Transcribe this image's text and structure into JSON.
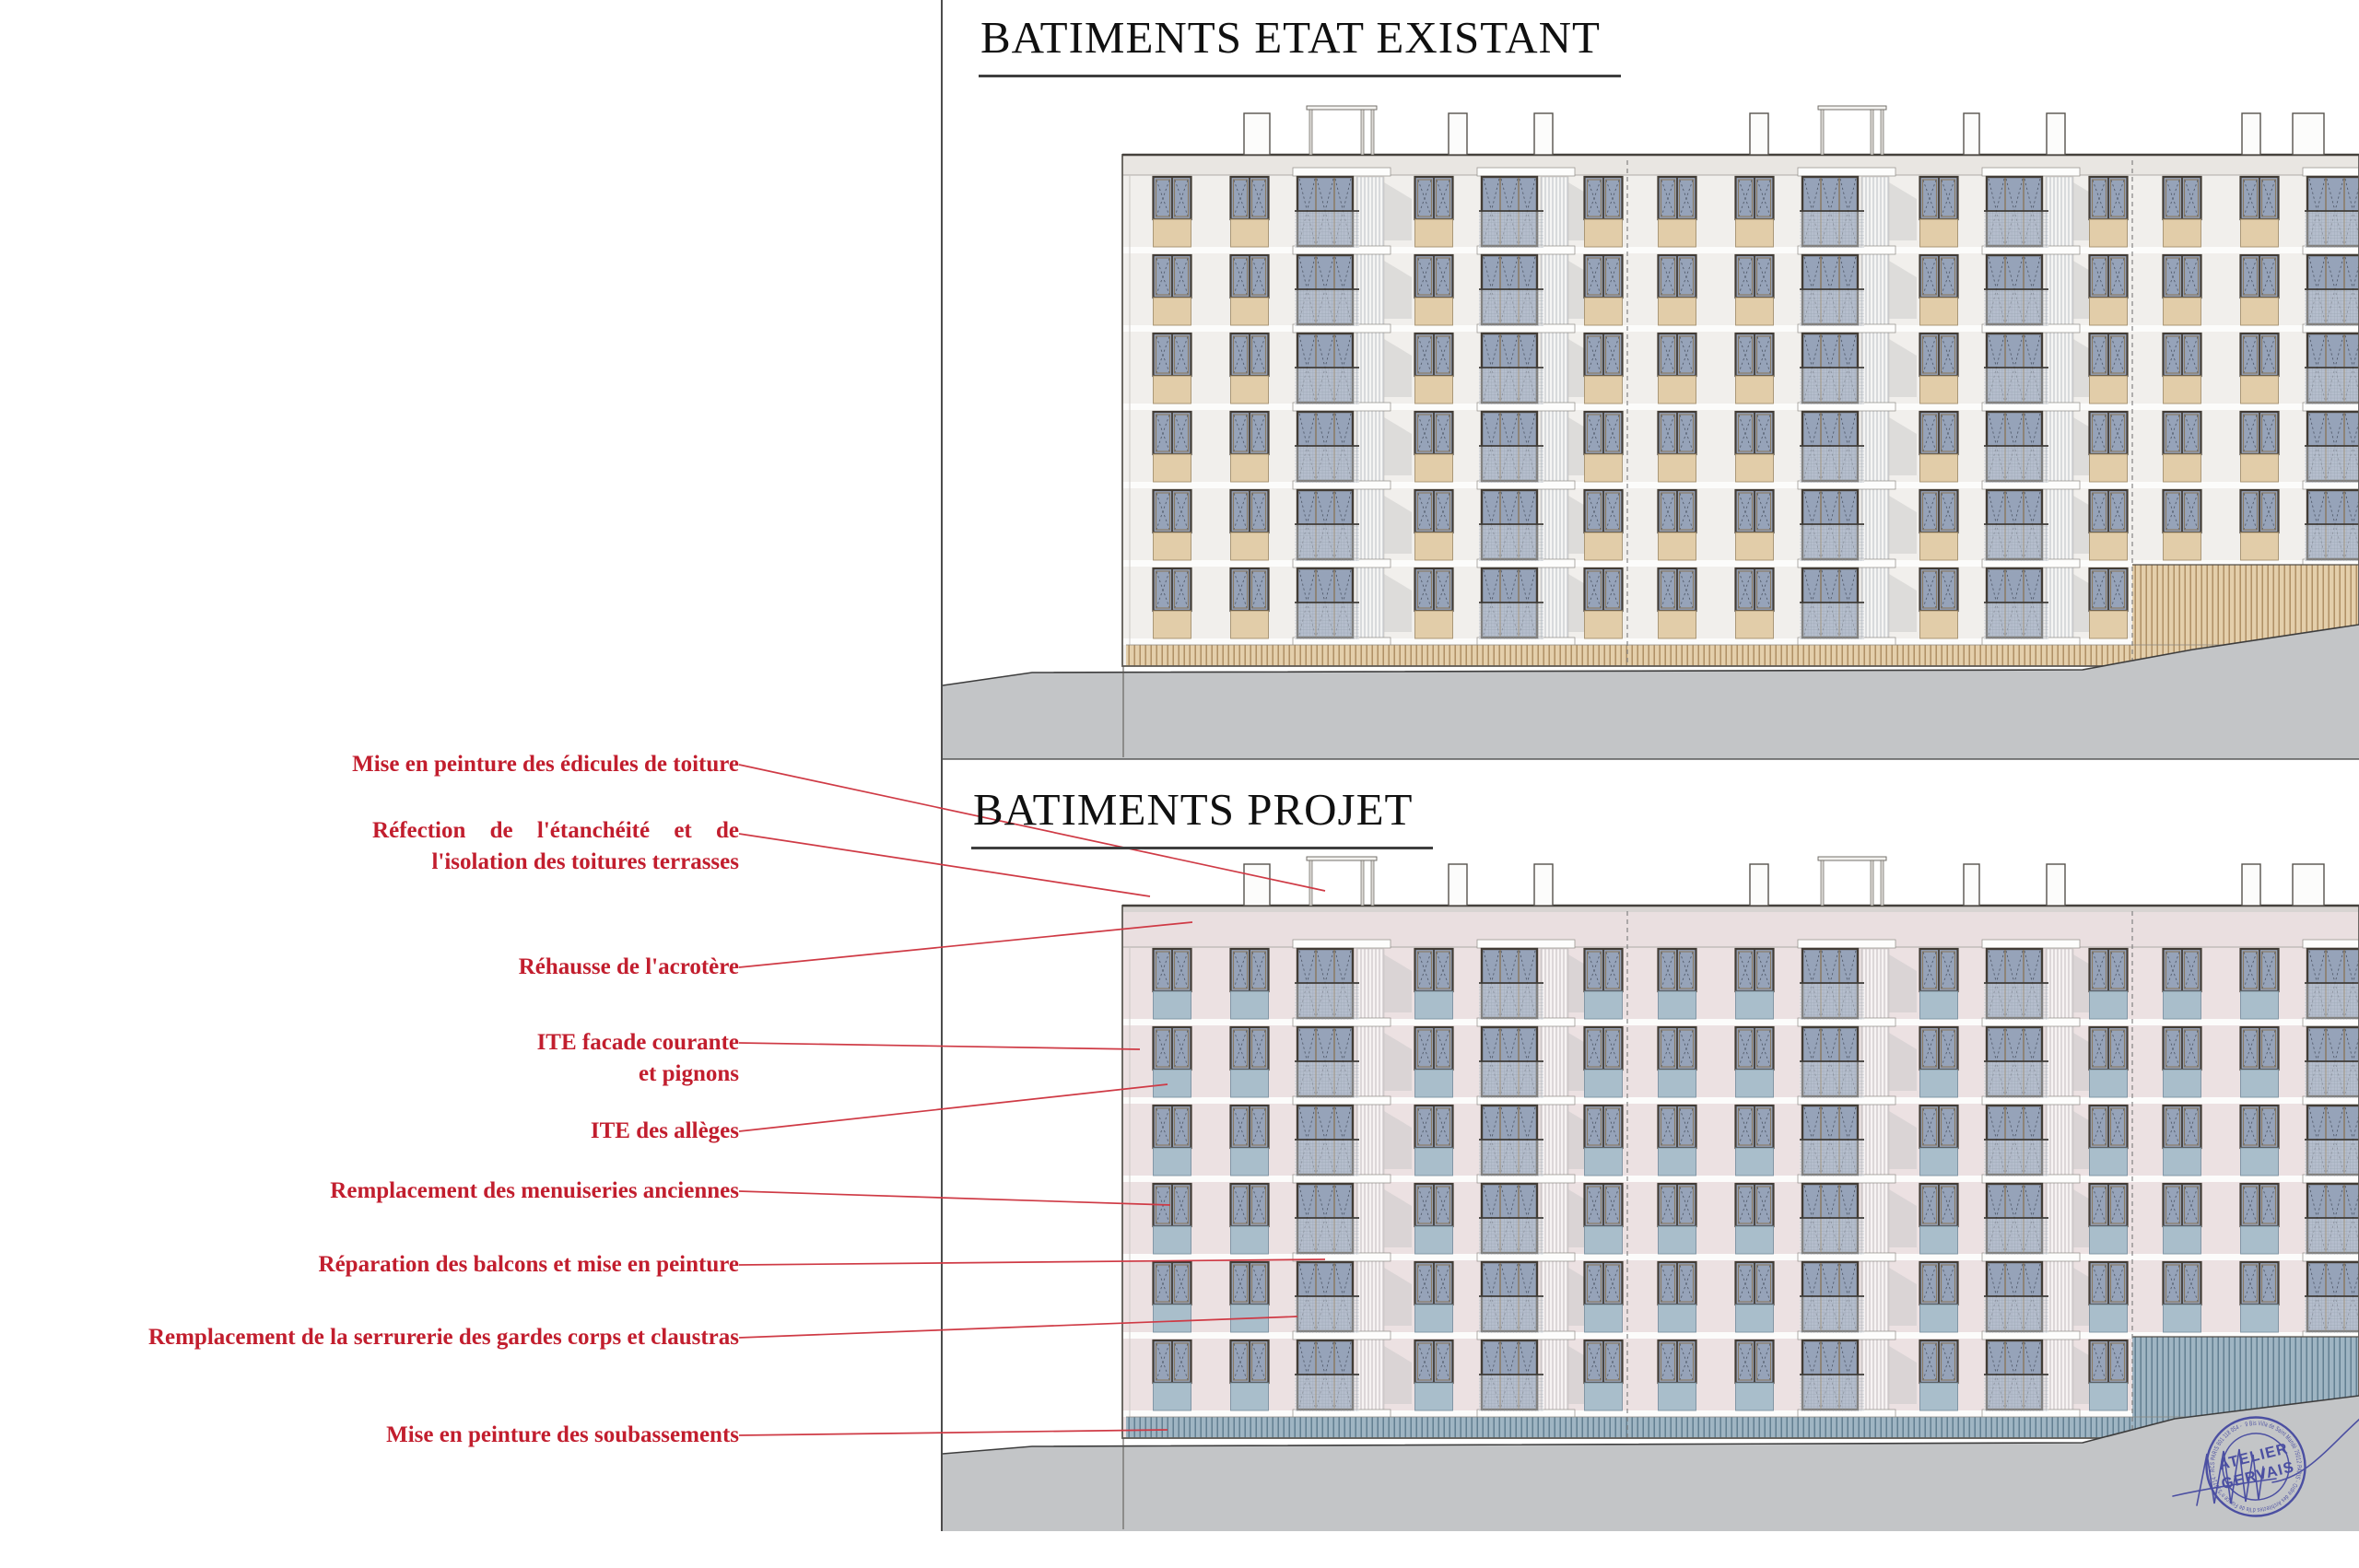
{
  "titles": {
    "existing": "BATIMENTS ETAT EXISTANT",
    "project": "BATIMENTS PROJET"
  },
  "annotations": [
    {
      "lines": [
        "Mise en peinture des édicules de toiture"
      ]
    },
    {
      "lines": [
        "Réfection de l'étanchéité et de",
        "l'isolation des toitures terrasses"
      ]
    },
    {
      "lines": [
        "Réhausse de l'acrotère"
      ]
    },
    {
      "lines": [
        "ITE facade courante",
        "et pignons"
      ]
    },
    {
      "lines": [
        "ITE des allèges"
      ]
    },
    {
      "lines": [
        "Remplacement des menuiseries anciennes"
      ]
    },
    {
      "lines": [
        "Réparation des balcons et mise en peinture"
      ]
    },
    {
      "lines": [
        "Remplacement de la serrurerie des gardes corps et claustras"
      ]
    },
    {
      "lines": [
        "Mise en peinture des soubassements"
      ]
    }
  ],
  "stamp": {
    "center_line1": "ATELIER",
    "center_line2": "GERVAIS",
    "ring_text": "9 Bis Villa de Saint Mandé 75012 PARIS - Ordre des Architectes d'Ile de France n°S19214 - RCS PARIS 801 118 054 -"
  },
  "colors": {
    "annotation_red": "#c21e2e",
    "leader_red": "#cf3a45",
    "divider_gray": "#4c4c4c",
    "ground_gray": "#c3c5c7",
    "ground_edge": "#3d3d3d",
    "stamp_blue": "#3b3f9d",
    "window_glass": "#96a3b9",
    "window_frame": "#423c35",
    "window_mullion": "#8a7a62",
    "existing": {
      "wall": "#f1efec",
      "parapet": "#e9e6e2",
      "panel": "#e2cda9",
      "panel_border": "#a4906e",
      "base_bg": "#e4cfab",
      "base_line": "#aa8a5f",
      "claustra_bg": "#f5f5f4",
      "claustra_line": "#b4b8be"
    },
    "project": {
      "wall": "#ece1e2",
      "parapet": "#eadfe0",
      "cap": "#d8d4d2",
      "panel": "#a9becb",
      "panel_border": "#7b91a0",
      "base_bg": "#9fb5c3",
      "base_line": "#5d7a8c",
      "claustra_bg": "#f7f3f3",
      "claustra_line": "#bdb5b9"
    }
  }
}
